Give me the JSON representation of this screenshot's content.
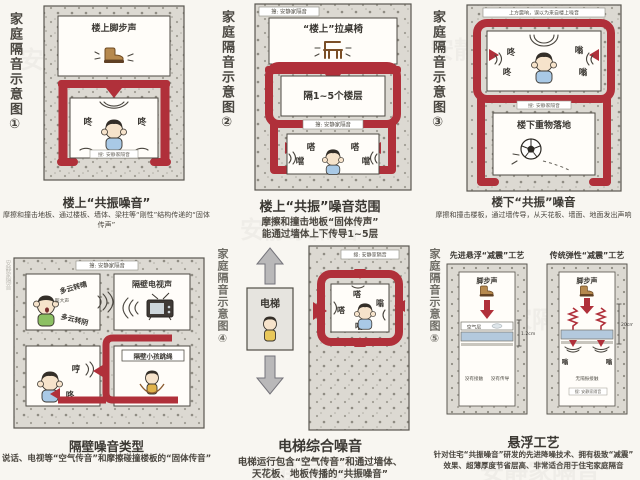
{
  "colors": {
    "background": "#f8f6f1",
    "concrete": "#dcd9d2",
    "speckle": "#9b988f",
    "accent_red": "#b0303a",
    "ink": "#3b3833",
    "blue_layer": "#b3c9dd",
    "boot_brown": "#b6894e",
    "elevator_gray": "#b9b8b9"
  },
  "watermark_tile": "安静家隔音",
  "panels": [
    {
      "side_title": "家庭隔音示意图①",
      "upper_label": "楼上脚步声",
      "chip": "搜: 安静家隔音",
      "sounds": [
        "咚",
        "咚"
      ],
      "caption": "楼上“共振噪音”",
      "sub": "摩擦和撞击地板、通过楼板、墙体、梁柱等“刚性”结构传递的“固体传声”"
    },
    {
      "side_title": "家庭隔音示意图②",
      "chip_top": "搜: 安静家隔音",
      "room1_label": "“楼上”拉桌椅",
      "room2_label": "隔1~5个楼层",
      "chip_mid": "搜: 安静家隔音",
      "sounds": [
        "嗒",
        "嗒",
        "噹",
        "噹"
      ],
      "caption": "楼上“共振”噪音范围",
      "sub1": "摩擦和撞击地板“固体传声”",
      "sub2": "能通过墙体上下传导1~5层"
    },
    {
      "side_title": "家庭隔音示意图③",
      "top_note": "上方震响，误以为来自楼上噪音",
      "sounds": [
        "咚",
        "嗡",
        "咚",
        "嗡"
      ],
      "chip": "搜: 安静家隔音",
      "room2_label": "楼下重物落地",
      "caption": "楼下“共振”噪音",
      "sub": "摩擦和撞击楼板，通过墙传导，从天花板、墙面、地面发出声响"
    },
    {
      "side_watermark": "安静家隔音",
      "chip_top": "搜: 安静家隔音",
      "lyric1": "多云转晴",
      "lyric2": "多云转阴",
      "tl_small": "超大声",
      "tr_label": "隔壁电视声",
      "bl_sounds": [
        "哼",
        "咚"
      ],
      "br_label": "隔壁小孩跳绳",
      "caption": "隔壁噪音类型",
      "sub": "说话、电视等“空气传音”和摩擦碰撞楼板的“固体传音”"
    },
    {
      "side_title": "家庭隔音示意图④",
      "elevator_label": "电梯",
      "chip": "搜: 安静家隔音",
      "sounds": [
        "嗒",
        "嗒",
        "嗡",
        "嗒"
      ],
      "caption": "电梯综合噪音",
      "sub1": "电梯运行包含“空气传音”和通过墙体、",
      "sub2": "天花板、地板传播的“共振噪音”"
    },
    {
      "side_title": "家庭隔音示意图⑤",
      "left": {
        "title": "先进悬浮“减震”工艺",
        "step": "脚步声",
        "air": "空气层",
        "dim": "1.2cm",
        "note1": "没有接触",
        "note2": "没有传导"
      },
      "right": {
        "title": "传统弹性“减震”工艺",
        "step": "脚步声",
        "dim": "20cm",
        "note": "无隔振接触",
        "sounds": [
          "嗡",
          "嗡"
        ],
        "chip": "搜: 安静家隔音"
      },
      "caption": "悬浮工艺",
      "sub1": "针对住宅“共振噪音”研发的先进降噪技术、拥有极致“减震”",
      "sub2": "效果、超薄厚度节省层高、非常适合用于住宅家庭隔音"
    }
  ]
}
